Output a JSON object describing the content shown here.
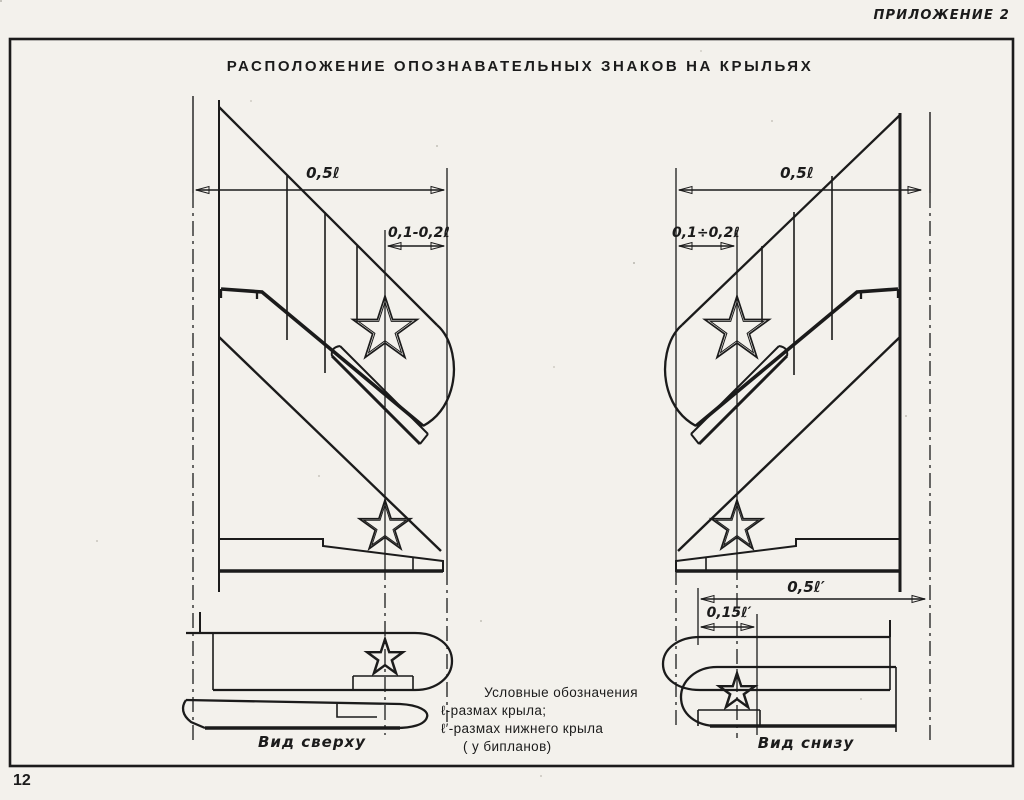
{
  "page": {
    "annex_label": "ПРИЛОЖЕНИЕ 2",
    "title": "РАСПОЛОЖЕНИЕ ОПОЗНАВАТЕЛЬНЫХ ЗНАКОВ НА КРЫЛЬЯХ",
    "page_number": "12"
  },
  "left_view": {
    "caption": "Вид сверху",
    "dim_half_span": "0,5ℓ",
    "dim_star_offset": "0,1-0,2ℓ"
  },
  "right_view": {
    "caption": "Вид снизу",
    "dim_half_span": "0,5ℓ",
    "dim_star_offset": "0,1÷0,2ℓ",
    "dim_lower_half_span": "0,5ℓ′",
    "dim_lower_star_offset": "0,15ℓ′"
  },
  "legend": {
    "title": "Условные обозначения",
    "line_wing_span": "ℓ-размах крыла;",
    "line_lower_wing_span": "ℓ′-размах нижнего крыла",
    "line_biplanes": "( у бипланов)"
  },
  "colors": {
    "ink": "#1b1b1b",
    "paper": "#f3f1ec"
  }
}
